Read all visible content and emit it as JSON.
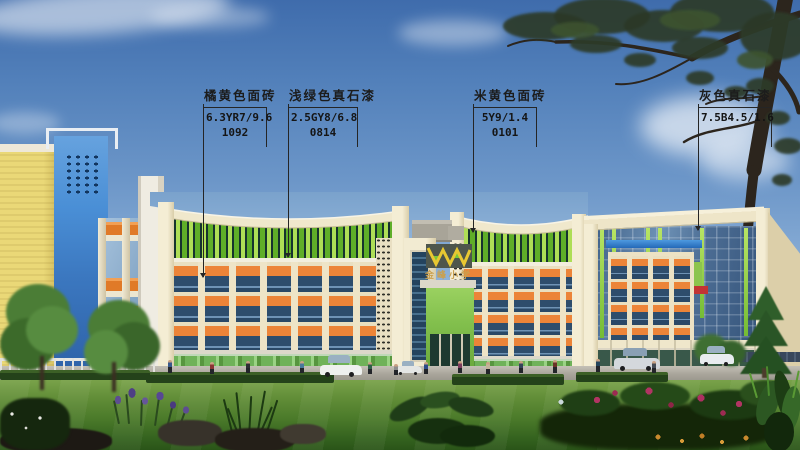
{
  "annotations": [
    {
      "label": "橘黄色面砖",
      "code1": "6.3YR7/9.6",
      "code2": "1092"
    },
    {
      "label": "浅绿色真石漆",
      "code1": "2.5GY8/6.8",
      "code2": "0814"
    },
    {
      "label": "米黄色面砖",
      "code1": "5Y9/1.4",
      "code2": "0101"
    },
    {
      "label": "灰色真石漆",
      "code1": "7.5B4.5/1.6",
      "code2": ""
    }
  ],
  "building": {
    "sign_text": "金峰小学"
  },
  "colors": {
    "sky_top": "#3f6cac",
    "sky_horizon": "#d5e3f0",
    "facade_cream": "#efe6c8",
    "spandrel_orange": "#e8823a",
    "fin_green_light": "#b2e05c",
    "fin_green_dark": "#64b02a",
    "window_glass": "#31506f",
    "ground_glass_green": "#74b65e",
    "neighbor_tower_blue": "#4a8fd6",
    "annotation_text": "#1c1c1c"
  }
}
